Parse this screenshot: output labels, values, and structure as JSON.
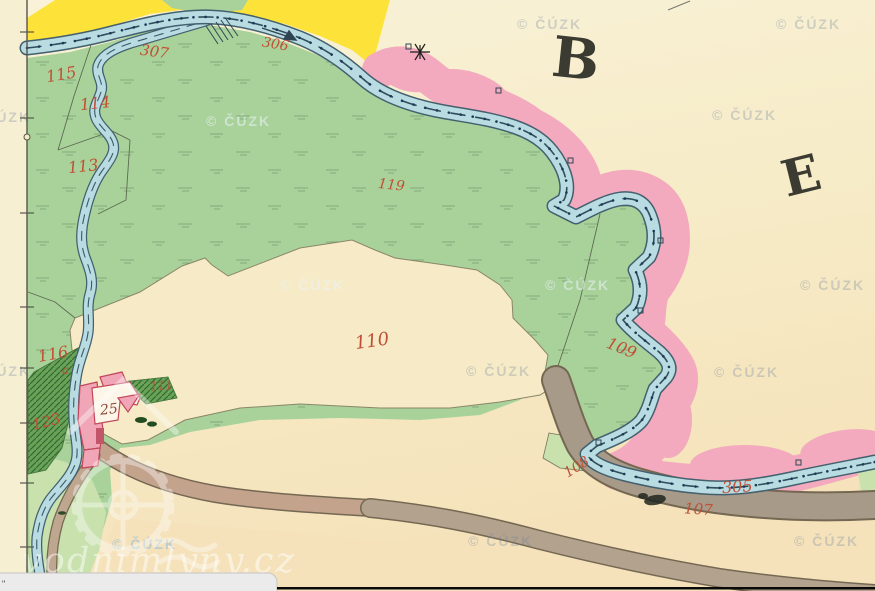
{
  "map": {
    "sheet_letters": [
      {
        "text": "B"
      },
      {
        "text": "E"
      }
    ],
    "parcel_labels": [
      {
        "text": "307"
      },
      {
        "text": "306"
      },
      {
        "text": "115"
      },
      {
        "text": "114"
      },
      {
        "text": "113"
      },
      {
        "text": "119"
      },
      {
        "text": "110"
      },
      {
        "text": "109"
      },
      {
        "text": "116"
      },
      {
        "text": "a"
      },
      {
        "text": "123"
      },
      {
        "text": "111"
      },
      {
        "text": "25"
      },
      {
        "text": "108"
      },
      {
        "text": "305"
      },
      {
        "text": "107"
      }
    ],
    "watermark": {
      "text": "© ČÚZK"
    },
    "site_watermark": {
      "text": "vodnimlyny.cz"
    },
    "overlay_box": {
      "text": "\""
    }
  },
  "colors": {
    "paper": "#f6ebc6",
    "paper_light": "#f9f2d8",
    "paper_deep": "#f5e2ba",
    "margin": "#f7efd2",
    "meadow": "#a9d29b",
    "meadow_light": "#c8e1ad",
    "yellow": "#fde23a",
    "pink": "#f3aabe",
    "water": "#b9dbe2",
    "water_edge": "#43606e",
    "road_gray": "#a89a88",
    "road_brown": "#c4a38c",
    "road_edge": "#756853",
    "garden": "#6aa257",
    "garden_hatch": "#2f6b33",
    "building": "#f0a6b6",
    "building_edge": "#c2475c",
    "label_red": "#c04f35",
    "label_dark": "#8a4a3c",
    "letter_dark": "#3b3b32",
    "parcel_line": "#5c6b50",
    "watermark_gray": "rgba(110,130,160,0.30)",
    "watermark_light": "rgba(235,242,248,0.55)",
    "watermark_blue": "rgba(140,185,220,0.55)",
    "site_white": "rgba(255,255,255,0.50)"
  }
}
